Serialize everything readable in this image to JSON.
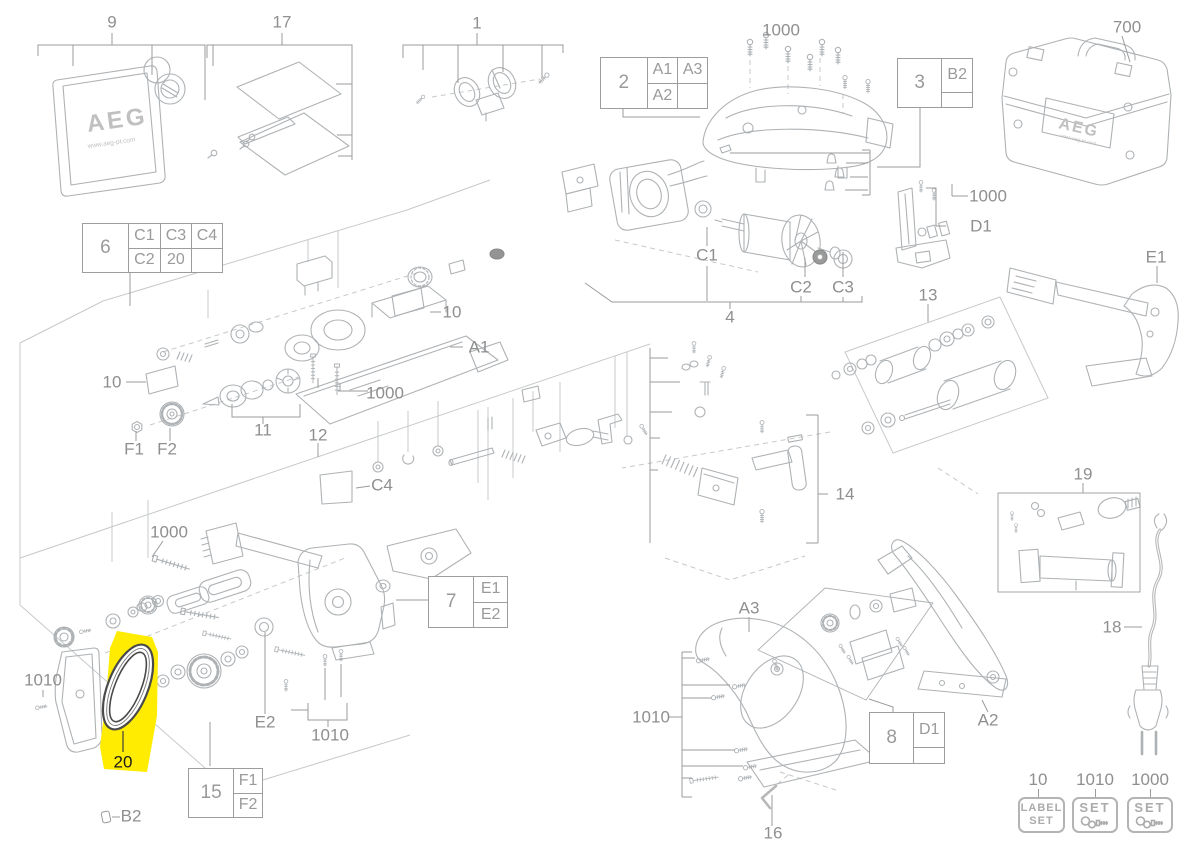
{
  "page": {
    "width": 1200,
    "height": 848,
    "background": "#ffffff",
    "highlight_color": "#ffec00",
    "line_color": "#adb1b4",
    "label_color": "#8f8f8f",
    "diagram_type": "exploded-parts-diagram"
  },
  "logos": {
    "brand": "AEG",
    "brand_url": "www.aeg-pt.com"
  },
  "highlighted_part": {
    "id": "20",
    "label": "20",
    "color": "#ffec00"
  },
  "labels": [
    {
      "id": "9",
      "text": "9",
      "x": 112,
      "y": 22
    },
    {
      "id": "17",
      "text": "17",
      "x": 282,
      "y": 22
    },
    {
      "id": "1",
      "text": "1",
      "x": 477,
      "y": 23
    },
    {
      "id": "1000-top",
      "text": "1000",
      "x": 781,
      "y": 30
    },
    {
      "id": "700",
      "text": "700",
      "x": 1127,
      "y": 27
    },
    {
      "id": "1000-d1",
      "text": "1000",
      "x": 988,
      "y": 196
    },
    {
      "id": "d1",
      "text": "D1",
      "x": 981,
      "y": 226
    },
    {
      "id": "e1",
      "text": "E1",
      "x": 1156,
      "y": 257
    },
    {
      "id": "13",
      "text": "13",
      "x": 928,
      "y": 295
    },
    {
      "id": "c1",
      "text": "C1",
      "x": 707,
      "y": 255
    },
    {
      "id": "c2",
      "text": "C2",
      "x": 801,
      "y": 287
    },
    {
      "id": "c3",
      "text": "C3",
      "x": 843,
      "y": 287
    },
    {
      "id": "4",
      "text": "4",
      "x": 730,
      "y": 317
    },
    {
      "id": "a1",
      "text": "A1",
      "x": 479,
      "y": 347
    },
    {
      "id": "10-a1",
      "text": "10",
      "x": 452,
      "y": 312
    },
    {
      "id": "1000-a1",
      "text": "1000",
      "x": 385,
      "y": 393
    },
    {
      "id": "10-left",
      "text": "10",
      "x": 112,
      "y": 382
    },
    {
      "id": "f1",
      "text": "F1",
      "x": 134,
      "y": 449
    },
    {
      "id": "f2",
      "text": "F2",
      "x": 167,
      "y": 449
    },
    {
      "id": "11",
      "text": "11",
      "x": 263,
      "y": 430
    },
    {
      "id": "12",
      "text": "12",
      "x": 318,
      "y": 435
    },
    {
      "id": "c4",
      "text": "C4",
      "x": 382,
      "y": 485
    },
    {
      "id": "14",
      "text": "14",
      "x": 845,
      "y": 494
    },
    {
      "id": "19",
      "text": "19",
      "x": 1083,
      "y": 474
    },
    {
      "id": "18",
      "text": "18",
      "x": 1112,
      "y": 627
    },
    {
      "id": "1000-belt",
      "text": "1000",
      "x": 169,
      "y": 532
    },
    {
      "id": "1010-knob",
      "text": "1010",
      "x": 43,
      "y": 680
    },
    {
      "id": "20",
      "text": "20",
      "x": 123,
      "y": 762,
      "hl": true
    },
    {
      "id": "b2-bottom",
      "text": "B2",
      "x": 131,
      "y": 816
    },
    {
      "id": "e2",
      "text": "E2",
      "x": 265,
      "y": 722
    },
    {
      "id": "1010-base",
      "text": "1010",
      "x": 330,
      "y": 735
    },
    {
      "id": "1010-handle",
      "text": "1010",
      "x": 651,
      "y": 717
    },
    {
      "id": "16",
      "text": "16",
      "x": 773,
      "y": 833
    },
    {
      "id": "a3",
      "text": "A3",
      "x": 749,
      "y": 608
    },
    {
      "id": "a2",
      "text": "A2",
      "x": 988,
      "y": 720
    }
  ],
  "ref_tables": [
    {
      "id": "2",
      "main": "2",
      "cols": 2,
      "cells": [
        "A1",
        "A3",
        "A2",
        ""
      ],
      "x": 600,
      "y": 57,
      "w": 108,
      "h": 52,
      "main_ratio": 0.44
    },
    {
      "id": "3",
      "main": "3",
      "cols": 1,
      "cells": [
        "B2",
        ""
      ],
      "x": 897,
      "y": 58,
      "w": 76,
      "h": 50,
      "main_ratio": 0.6
    },
    {
      "id": "6",
      "main": "6",
      "cols": 3,
      "cells": [
        "C1",
        "C3",
        "C4",
        "C2",
        "20",
        ""
      ],
      "x": 82,
      "y": 223,
      "w": 141,
      "h": 50,
      "main_ratio": 0.33
    },
    {
      "id": "7",
      "main": "7",
      "cols": 1,
      "cells": [
        "E1",
        "E2"
      ],
      "x": 428,
      "y": 576,
      "w": 80,
      "h": 52,
      "main_ratio": 0.58
    },
    {
      "id": "8",
      "main": "8",
      "cols": 1,
      "cells": [
        "D1",
        ""
      ],
      "x": 869,
      "y": 712,
      "w": 76,
      "h": 52,
      "main_ratio": 0.6
    },
    {
      "id": "15",
      "main": "15",
      "cols": 1,
      "cells": [
        "F1",
        "F2"
      ],
      "x": 188,
      "y": 768,
      "w": 75,
      "h": 50,
      "main_ratio": 0.62
    }
  ],
  "badges": [
    {
      "number": "10",
      "lines": [
        "LABEL",
        "SET"
      ],
      "icon": false,
      "x": 1018,
      "y": 797,
      "w": 47,
      "h": 36,
      "num_x": 1038,
      "num_y": 780
    },
    {
      "number": "1010",
      "lines": [
        "SET"
      ],
      "icon": true,
      "x": 1072,
      "y": 797,
      "w": 46,
      "h": 36,
      "num_x": 1095,
      "num_y": 780
    },
    {
      "number": "1000",
      "lines": [
        "SET"
      ],
      "icon": true,
      "x": 1127,
      "y": 797,
      "w": 46,
      "h": 36,
      "num_x": 1150,
      "num_y": 780
    }
  ]
}
